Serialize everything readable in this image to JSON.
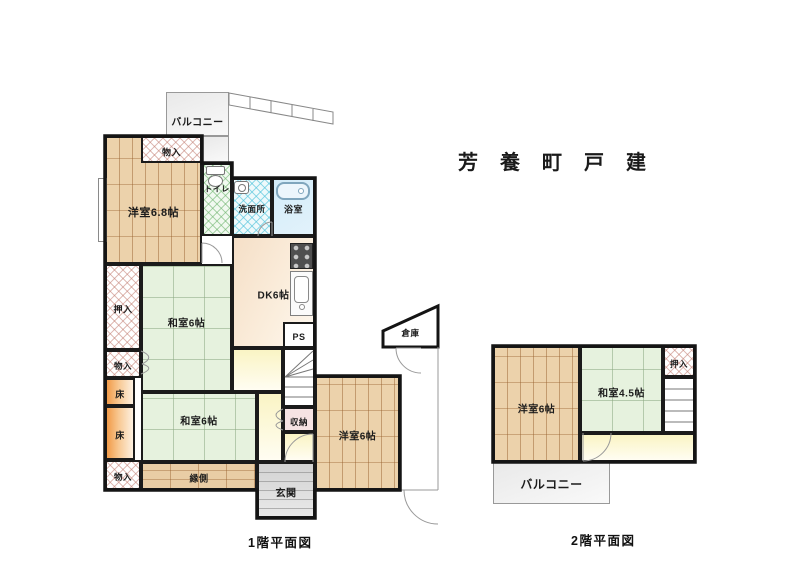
{
  "title": "芳養町戸建",
  "floor1": {
    "caption": "1階平面図",
    "rooms": [
      {
        "id": "balcony-1f",
        "label": "バルコニー",
        "kind": "balcony",
        "x": 166,
        "y": 92,
        "w": 63,
        "h": 44,
        "fs": 10,
        "ly": 120
      },
      {
        "id": "balcony-1f-ext",
        "label": "",
        "kind": "balcony",
        "x": 202,
        "y": 136,
        "w": 27,
        "h": 27
      },
      {
        "id": "yoshitsu-6-8",
        "label": "洋室6.8帖",
        "kind": "wood-v",
        "x": 105,
        "y": 136,
        "w": 97,
        "h": 128,
        "fs": 11,
        "ly": 210
      },
      {
        "id": "monoire-top",
        "label": "物入",
        "kind": "closet",
        "x": 141,
        "y": 136,
        "w": 61,
        "h": 27,
        "fs": 9
      },
      {
        "id": "toilet-room",
        "label": "トイレ",
        "kind": "toilet",
        "x": 202,
        "y": 163,
        "w": 30,
        "h": 73,
        "fs": 8,
        "ly": 187
      },
      {
        "id": "senmenjo",
        "label": "洗面所",
        "kind": "washroom",
        "x": 232,
        "y": 178,
        "w": 40,
        "h": 58,
        "fs": 8.5
      },
      {
        "id": "bathroom",
        "label": "浴室",
        "kind": "bath",
        "x": 272,
        "y": 178,
        "w": 43,
        "h": 58,
        "fs": 9
      },
      {
        "id": "dk",
        "label": "DK6帖",
        "kind": "dk",
        "x": 232,
        "y": 236,
        "w": 83,
        "h": 112,
        "fs": 10
      },
      {
        "id": "ps",
        "label": "PS",
        "kind": "plain",
        "x": 283,
        "y": 322,
        "w": 32,
        "h": 26,
        "fs": 9
      },
      {
        "id": "oshiire-1f",
        "label": "押入",
        "kind": "closet",
        "x": 105,
        "y": 264,
        "w": 36,
        "h": 86,
        "fs": 9
      },
      {
        "id": "washitsu-6-upper",
        "label": "和室6帖",
        "kind": "tatami",
        "x": 141,
        "y": 264,
        "w": 91,
        "h": 128,
        "fs": 10,
        "ly": 320
      },
      {
        "id": "monoire-mid",
        "label": "物入",
        "kind": "closet",
        "x": 105,
        "y": 350,
        "w": 36,
        "h": 28,
        "fs": 8.5
      },
      {
        "id": "toko-1",
        "label": "床",
        "kind": "toko",
        "x": 105,
        "y": 378,
        "w": 30,
        "h": 28,
        "fs": 9
      },
      {
        "id": "toko-2",
        "label": "床",
        "kind": "toko",
        "x": 105,
        "y": 406,
        "w": 30,
        "h": 54,
        "fs": 9
      },
      {
        "id": "washitsu-6-lower",
        "label": "和室6帖",
        "kind": "tatami",
        "x": 141,
        "y": 392,
        "w": 116,
        "h": 70,
        "fs": 10,
        "ly": 418
      },
      {
        "id": "monoire-bottom",
        "label": "物入",
        "kind": "closet",
        "x": 105,
        "y": 460,
        "w": 36,
        "h": 30,
        "fs": 8.5
      },
      {
        "id": "hall-a",
        "label": "",
        "kind": "hall",
        "x": 232,
        "y": 348,
        "w": 51,
        "h": 44
      },
      {
        "id": "hall-c",
        "label": "",
        "kind": "hall",
        "x": 257,
        "y": 392,
        "w": 26,
        "h": 70
      },
      {
        "id": "hall-b",
        "label": "",
        "kind": "hall",
        "x": 283,
        "y": 432,
        "w": 32,
        "h": 30
      },
      {
        "id": "stairs-1f",
        "label": "",
        "kind": "stairs",
        "x": 283,
        "y": 348,
        "w": 32,
        "h": 59
      },
      {
        "id": "shuunou",
        "label": "収納",
        "kind": "storage2",
        "x": 283,
        "y": 407,
        "w": 32,
        "h": 25,
        "fs": 8.5
      },
      {
        "id": "engawa",
        "label": "縁側",
        "kind": "wood-h",
        "x": 141,
        "y": 462,
        "w": 116,
        "h": 28,
        "fs": 9
      },
      {
        "id": "genkan",
        "label": "玄関",
        "kind": "genkan",
        "x": 257,
        "y": 462,
        "w": 58,
        "h": 56,
        "fs": 10
      },
      {
        "id": "yoshitsu-6-1f",
        "label": "洋室6帖",
        "kind": "wood-v",
        "x": 315,
        "y": 376,
        "w": 85,
        "h": 114,
        "fs": 10
      },
      {
        "id": "souko",
        "label": "倉庫",
        "kind": "label-only",
        "x": 385,
        "y": 322,
        "w": 51,
        "h": 22,
        "fs": 8.5
      }
    ],
    "fixtures": [
      {
        "id": "toilet-tank",
        "kind": "box",
        "x": 206,
        "y": 166,
        "w": 19,
        "h": 9
      },
      {
        "id": "toilet-bowl",
        "kind": "ellipse",
        "x": 208,
        "y": 175,
        "w": 15,
        "h": 12
      },
      {
        "id": "washbasin",
        "kind": "basin",
        "x": 234,
        "y": 181,
        "w": 15,
        "h": 13
      },
      {
        "id": "bathtub",
        "kind": "tub",
        "x": 276,
        "y": 182,
        "w": 34,
        "h": 18
      },
      {
        "id": "stove",
        "kind": "stove",
        "x": 290,
        "y": 243,
        "w": 23,
        "h": 26
      },
      {
        "id": "kitchen-sink",
        "kind": "sink",
        "x": 290,
        "y": 271,
        "w": 23,
        "h": 45
      },
      {
        "id": "bay-window",
        "kind": "bay",
        "x": 98,
        "y": 178,
        "w": 9,
        "h": 64
      }
    ]
  },
  "floor2": {
    "caption": "2階平面図",
    "rooms": [
      {
        "id": "yoshitsu-6-2f",
        "label": "洋室6帖",
        "kind": "wood-v",
        "x": 493,
        "y": 346,
        "w": 87,
        "h": 116,
        "fs": 10,
        "ly": 406
      },
      {
        "id": "washitsu-4-5",
        "label": "和室4.5帖",
        "kind": "tatami",
        "x": 580,
        "y": 346,
        "w": 83,
        "h": 87,
        "fs": 10
      },
      {
        "id": "oshiire-2f",
        "label": "押入",
        "kind": "closet",
        "x": 663,
        "y": 346,
        "w": 32,
        "h": 31,
        "fs": 8.5
      },
      {
        "id": "stairs-2f",
        "label": "",
        "kind": "stairs",
        "x": 663,
        "y": 377,
        "w": 32,
        "h": 56
      },
      {
        "id": "hall-2f",
        "label": "",
        "kind": "hall",
        "x": 580,
        "y": 433,
        "w": 115,
        "h": 29
      },
      {
        "id": "balcony-2f",
        "label": "バルコニー",
        "kind": "balcony",
        "x": 493,
        "y": 462,
        "w": 117,
        "h": 42,
        "fs": 12
      }
    ],
    "fixtures": []
  },
  "colors": {
    "wall": "#1b1b1b",
    "wood": "#ecd2ab",
    "tatami": "#e6f2de",
    "hall": "#faf4c4",
    "dk": "#f5dfc7",
    "toko": "#f19a48",
    "bath": "#d3ecf9",
    "closet_hatch": "#c07a6e",
    "washroom_hatch": "#50c3dc",
    "toilet_hatch": "#6eb46e",
    "genkan": "#d2d2d2",
    "balcony": "#ededed"
  }
}
